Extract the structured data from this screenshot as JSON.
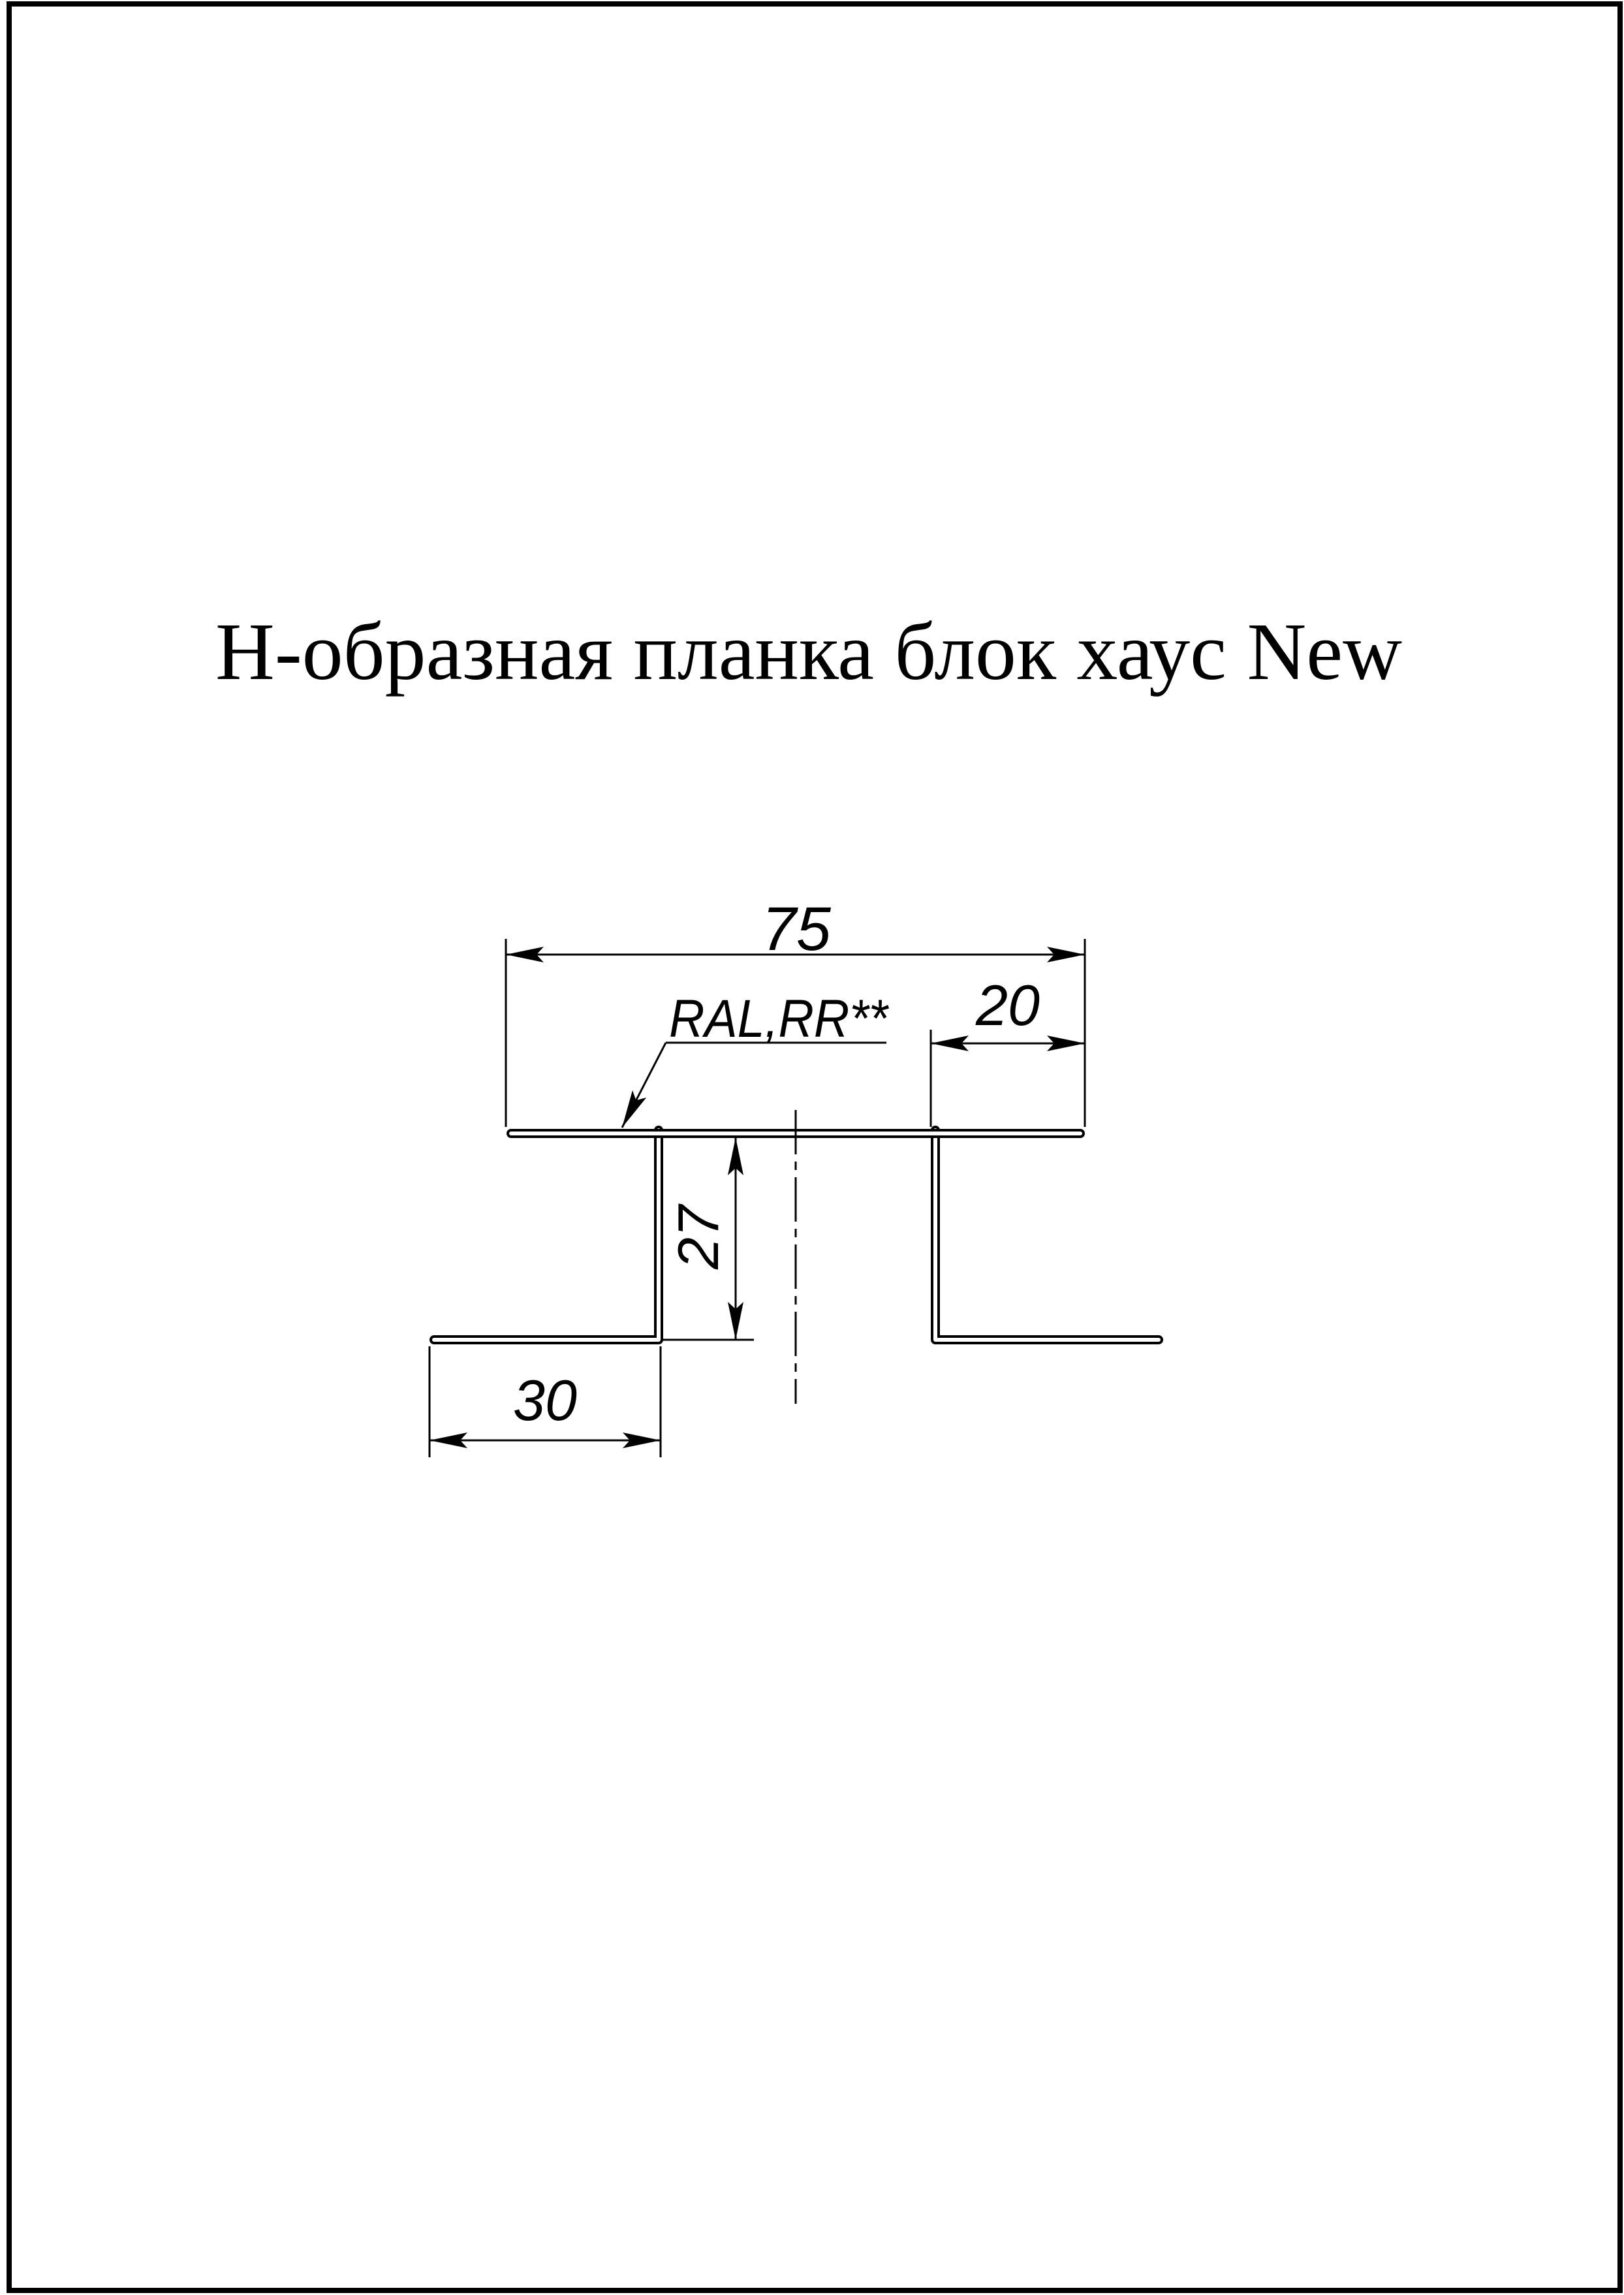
{
  "page": {
    "title": "Н-образная планка блок хаус New"
  },
  "drawing": {
    "coating_label": "RAL,RR**",
    "dimensions": {
      "top_width": "75",
      "right_offset": "20",
      "leg_height": "27",
      "bottom_flange_width": "30"
    },
    "colors": {
      "ink": "#000000",
      "paper": "#ffffff"
    }
  }
}
